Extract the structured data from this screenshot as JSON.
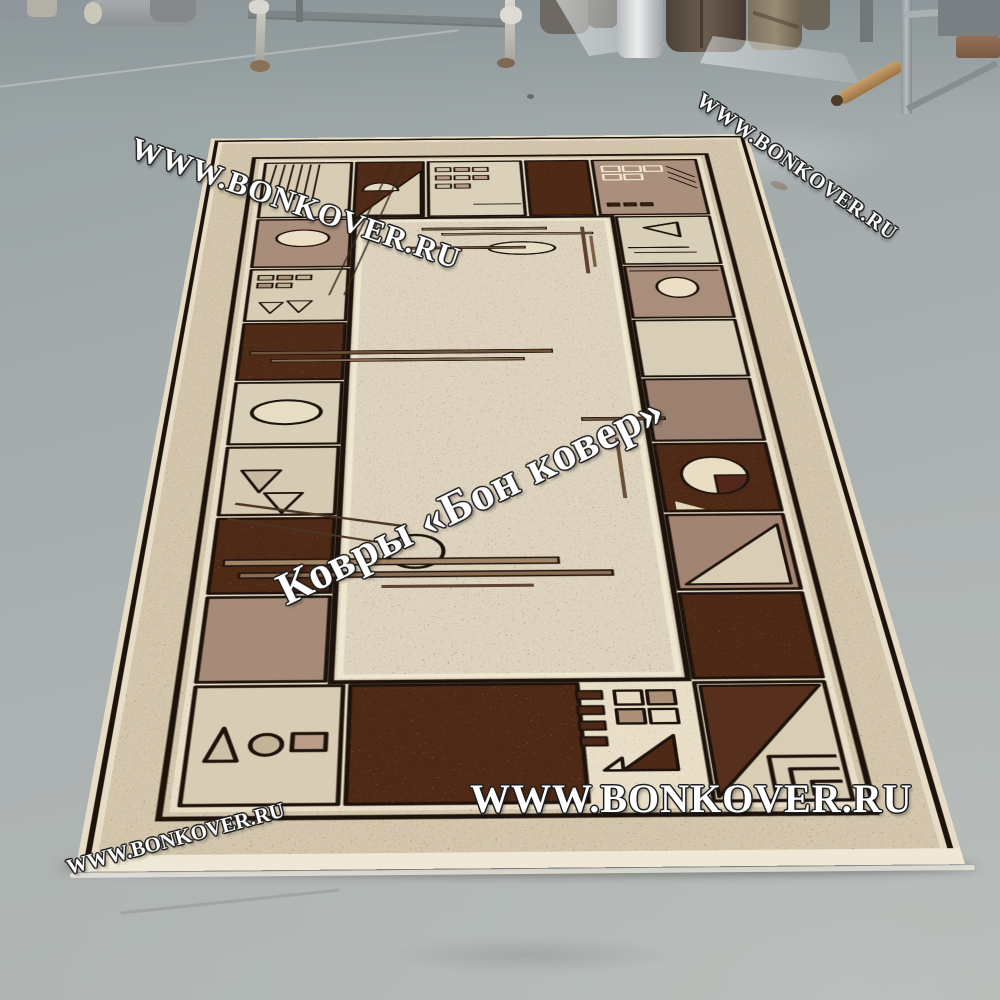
{
  "watermarks": {
    "top_left": "WWW.BONKOVER.RU",
    "top_right": "WWW.BONKOVER.RU",
    "center": "Ковры «Бон ковер»",
    "bottom": "WWW.BONKOVER.RU",
    "bottom_left": "WWW.BONKOVER.RU"
  },
  "palette": {
    "floor_grey": "#a8b0b0",
    "rug_field": "#ddd3bf",
    "rug_outer_band": "#d3c6ad",
    "cell_beige": "#d8ccb5",
    "cell_mauve": "#a98d7b",
    "cell_dark_brown": "#4e2916",
    "outline_black": "#1e130b",
    "outline_cream": "#efe6cf",
    "watermark_fill": "#ffffff"
  },
  "scene": {
    "setting": "warehouse interior with grey painted concrete floor",
    "subject": "beige rug with brown geometric bordered pattern laid on the floor, photographed in perspective",
    "background_objects": [
      "grey cylinders",
      "rolled carpets standing upright",
      "white film roll",
      "translucent plastic sheets",
      "metal display stand",
      "metal storage rack",
      "cardboard tube lying on floor"
    ]
  }
}
